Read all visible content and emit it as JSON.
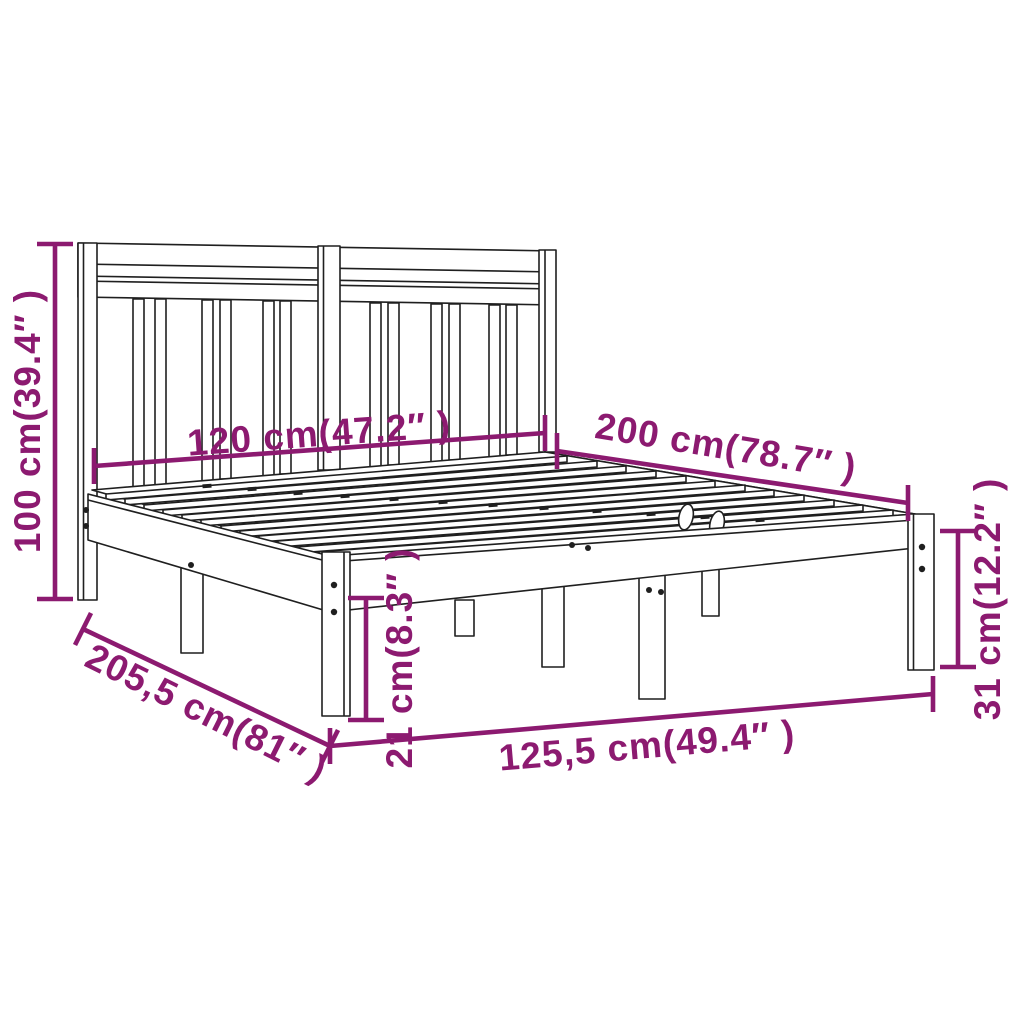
{
  "diagram": {
    "title": "Bed frame with headboard — dimension diagram",
    "product": "wooden-bed-frame",
    "colors": {
      "dimension_accent": "#8c1a70",
      "drawing_outline": "#1f1f1f",
      "background": "#ffffff"
    },
    "dimensions": [
      {
        "id": "headboard-height",
        "label": "100 cm(39.4″ )",
        "value_cm": "100",
        "value_in": "39.4"
      },
      {
        "id": "bed-width",
        "label": "120 cm(47.2″ )",
        "value_cm": "120",
        "value_in": "47.2"
      },
      {
        "id": "bed-length",
        "label": "200 cm(78.7″ )",
        "value_cm": "200",
        "value_in": "78.7"
      },
      {
        "id": "frame-length",
        "label": "205,5 cm(81″ )",
        "value_cm": "205,5",
        "value_in": "81"
      },
      {
        "id": "under-bed-clearance",
        "label": "21 cm(8.3″ )",
        "value_cm": "21",
        "value_in": "8.3"
      },
      {
        "id": "frame-width",
        "label": "125,5 cm(49.4″ )",
        "value_cm": "125,5",
        "value_in": "49.4"
      },
      {
        "id": "side-rail-height",
        "label": "31 cm(12.2″ )",
        "value_cm": "31",
        "value_in": "12.2"
      }
    ]
  }
}
